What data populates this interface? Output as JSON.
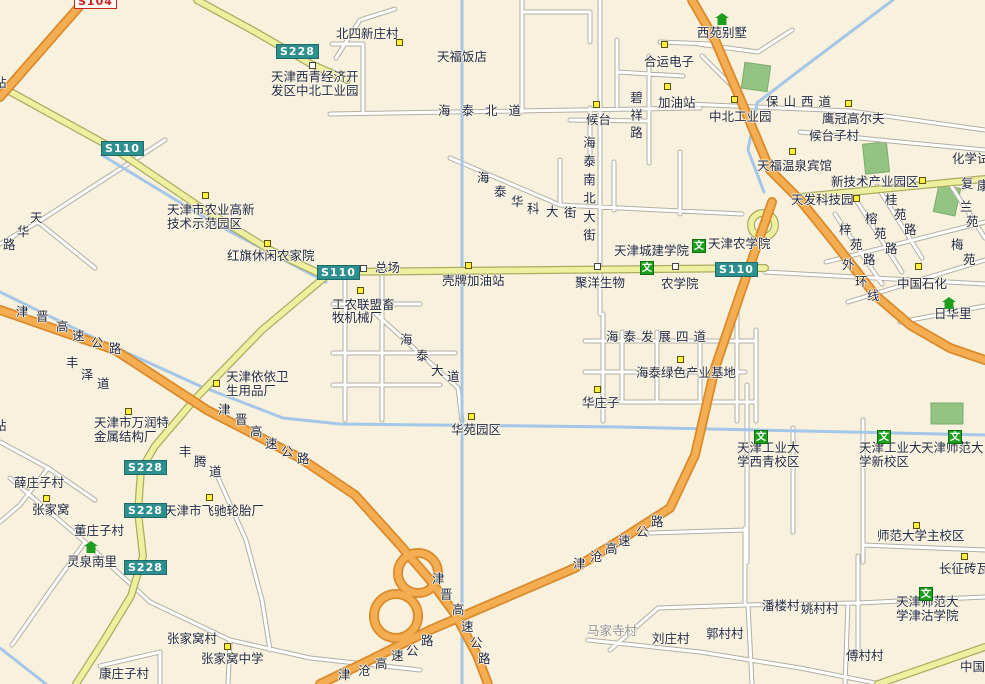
{
  "map": {
    "colors": {
      "background": "#f8f1dd",
      "road_fill": "#ffffff",
      "road_border": "#b2aea4",
      "provincial_road": "#eef0a0",
      "provincial_border": "#aaac62",
      "expressway": "#f5ad52",
      "expressway_border": "#d98a2b",
      "river": "#a4c6e8",
      "park": "#94c483",
      "badge_teal": "#2e8f8f",
      "badge_red": "#cc2222",
      "label": "#1f2a4a"
    },
    "wen_glyph": "文",
    "road_badges": [
      {
        "label": "S104",
        "x": 74,
        "y": -6,
        "cls": "red"
      },
      {
        "label": "S228",
        "x": 276,
        "y": 44,
        "cls": ""
      },
      {
        "label": "S110",
        "x": 101,
        "y": 141,
        "cls": ""
      },
      {
        "label": "S110",
        "x": 317,
        "y": 265,
        "cls": ""
      },
      {
        "label": "S110",
        "x": 715,
        "y": 262,
        "cls": ""
      },
      {
        "label": "S228",
        "x": 124,
        "y": 460,
        "cls": ""
      },
      {
        "label": "S228",
        "x": 124,
        "y": 503,
        "cls": ""
      },
      {
        "label": "S228",
        "x": 124,
        "y": 560,
        "cls": ""
      }
    ],
    "poi_markers": [
      {
        "type": "y",
        "x": 396,
        "y": 39
      },
      {
        "type": "y",
        "x": 661,
        "y": 41
      },
      {
        "type": "y",
        "x": 664,
        "y": 83
      },
      {
        "type": "y",
        "x": 593,
        "y": 101
      },
      {
        "type": "y",
        "x": 731,
        "y": 96
      },
      {
        "type": "y",
        "x": 845,
        "y": 100
      },
      {
        "type": "y",
        "x": 789,
        "y": 148
      },
      {
        "type": "y",
        "x": 919,
        "y": 177
      },
      {
        "type": "y",
        "x": 853,
        "y": 195
      },
      {
        "type": "y",
        "x": 915,
        "y": 263
      },
      {
        "type": "y",
        "x": 202,
        "y": 192
      },
      {
        "type": "y",
        "x": 264,
        "y": 240
      },
      {
        "type": "y",
        "x": 465,
        "y": 262
      },
      {
        "type": "y",
        "x": 357,
        "y": 287
      },
      {
        "type": "y",
        "x": 677,
        "y": 356
      },
      {
        "type": "y",
        "x": 594,
        "y": 386
      },
      {
        "type": "y",
        "x": 468,
        "y": 413
      },
      {
        "type": "y",
        "x": 213,
        "y": 380
      },
      {
        "type": "y",
        "x": 125,
        "y": 408
      },
      {
        "type": "y",
        "x": 43,
        "y": 495
      },
      {
        "type": "y",
        "x": 206,
        "y": 494
      },
      {
        "type": "y",
        "x": 224,
        "y": 643
      },
      {
        "type": "y",
        "x": 913,
        "y": 522
      },
      {
        "type": "y",
        "x": 961,
        "y": 553
      },
      {
        "type": "w",
        "x": 309,
        "y": 62
      },
      {
        "type": "w",
        "x": 360,
        "y": 265
      },
      {
        "type": "w",
        "x": 594,
        "y": 263
      },
      {
        "type": "w",
        "x": 672,
        "y": 263
      },
      {
        "type": "wen",
        "x": 692,
        "y": 239
      },
      {
        "type": "wen",
        "x": 640,
        "y": 261
      },
      {
        "type": "wen",
        "x": 754,
        "y": 430
      },
      {
        "type": "wen",
        "x": 877,
        "y": 430
      },
      {
        "type": "wen",
        "x": 948,
        "y": 430
      },
      {
        "type": "wen",
        "x": 919,
        "y": 587
      },
      {
        "type": "house",
        "x": 715,
        "y": 13
      },
      {
        "type": "house",
        "x": 942,
        "y": 297
      },
      {
        "type": "house",
        "x": 84,
        "y": 541
      }
    ],
    "region_labels": [
      {
        "t": "北四新庄村",
        "x": 336,
        "y": 27
      },
      {
        "t": "天福饭店",
        "x": 437,
        "y": 50
      },
      {
        "t": "天津西青经济开",
        "x": 271,
        "y": 70
      },
      {
        "t": "发区中北工业园",
        "x": 271,
        "y": 84
      },
      {
        "t": "西苑别墅",
        "x": 697,
        "y": 26
      },
      {
        "t": "合运电子",
        "x": 644,
        "y": 55
      },
      {
        "t": "保山西道",
        "x": 766,
        "y": 95,
        "cls": "sp2"
      },
      {
        "t": "加油站",
        "x": 658,
        "y": 96
      },
      {
        "t": "中北工业园",
        "x": 709,
        "y": 110
      },
      {
        "t": "鹰冠高尔夫",
        "x": 822,
        "y": 112
      },
      {
        "t": "候台",
        "x": 586,
        "y": 113
      },
      {
        "t": "候台子村",
        "x": 809,
        "y": 129
      },
      {
        "t": "海泰北道",
        "x": 438,
        "y": 104,
        "cls": "sp1"
      },
      {
        "t": "碧祥路",
        "x": 629,
        "y": 91,
        "cls": "vert"
      },
      {
        "t": "海泰南北大街",
        "x": 582,
        "y": 136,
        "cls": "vert2"
      },
      {
        "t": "化学试",
        "x": 952,
        "y": 152
      },
      {
        "t": "天福温泉宾馆",
        "x": 757,
        "y": 159
      },
      {
        "t": "新技术产业园区",
        "x": 831,
        "y": 175
      },
      {
        "t": "天发科技园",
        "x": 791,
        "y": 193
      },
      {
        "t": "复",
        "x": 961,
        "y": 177
      },
      {
        "t": "康",
        "x": 977,
        "y": 179
      },
      {
        "t": "桂",
        "x": 885,
        "y": 193
      },
      {
        "t": "苑",
        "x": 894,
        "y": 208
      },
      {
        "t": "路",
        "x": 904,
        "y": 223
      },
      {
        "t": "榕",
        "x": 865,
        "y": 212
      },
      {
        "t": "苑",
        "x": 874,
        "y": 227
      },
      {
        "t": "路",
        "x": 885,
        "y": 242
      },
      {
        "t": "梓",
        "x": 839,
        "y": 223
      },
      {
        "t": "苑",
        "x": 850,
        "y": 238
      },
      {
        "t": "路",
        "x": 863,
        "y": 253
      },
      {
        "t": "兰",
        "x": 960,
        "y": 200
      },
      {
        "t": "苑",
        "x": 966,
        "y": 215
      },
      {
        "t": "梅",
        "x": 951,
        "y": 238
      },
      {
        "t": "苑",
        "x": 963,
        "y": 253
      },
      {
        "t": "外",
        "x": 842,
        "y": 258
      },
      {
        "t": "环",
        "x": 855,
        "y": 275
      },
      {
        "t": "线",
        "x": 867,
        "y": 289
      },
      {
        "t": "中国石化",
        "x": 897,
        "y": 277
      },
      {
        "t": "天津农学院",
        "x": 708,
        "y": 237
      },
      {
        "t": "天津城建学院",
        "x": 614,
        "y": 244
      },
      {
        "t": "农学院",
        "x": 661,
        "y": 277
      },
      {
        "t": "聚洋生物",
        "x": 575,
        "y": 276
      },
      {
        "t": "总场",
        "x": 375,
        "y": 261
      },
      {
        "t": "壳牌加油站",
        "x": 442,
        "y": 274
      },
      {
        "t": "日华里",
        "x": 934,
        "y": 307
      },
      {
        "t": "天津市农业高新",
        "x": 167,
        "y": 203
      },
      {
        "t": "技术示范园区",
        "x": 167,
        "y": 217
      },
      {
        "t": "红旗休闲农家院",
        "x": 227,
        "y": 249
      },
      {
        "t": "天",
        "x": 30,
        "y": 211
      },
      {
        "t": "华",
        "x": 17,
        "y": 225
      },
      {
        "t": "路",
        "x": 3,
        "y": 238
      },
      {
        "t": "海",
        "x": 477,
        "y": 171
      },
      {
        "t": "泰",
        "x": 494,
        "y": 185
      },
      {
        "t": "华",
        "x": 511,
        "y": 195
      },
      {
        "t": "科",
        "x": 527,
        "y": 202
      },
      {
        "t": "大",
        "x": 546,
        "y": 205
      },
      {
        "t": "街",
        "x": 564,
        "y": 206
      },
      {
        "t": "工农联盟畜",
        "x": 332,
        "y": 298
      },
      {
        "t": "牧机械厂",
        "x": 332,
        "y": 311
      },
      {
        "t": "海",
        "x": 400,
        "y": 333
      },
      {
        "t": "泰",
        "x": 416,
        "y": 349
      },
      {
        "t": "大",
        "x": 431,
        "y": 364
      },
      {
        "t": "道",
        "x": 447,
        "y": 370
      },
      {
        "t": "海泰发展四道",
        "x": 606,
        "y": 330,
        "cls": "sp2"
      },
      {
        "t": "海泰绿色产业基地",
        "x": 636,
        "y": 366
      },
      {
        "t": "华庄子",
        "x": 582,
        "y": 396
      },
      {
        "t": "华苑园区",
        "x": 451,
        "y": 423
      },
      {
        "t": "津",
        "x": 16,
        "y": 305
      },
      {
        "t": "晋",
        "x": 36,
        "y": 310
      },
      {
        "t": "高",
        "x": 56,
        "y": 320
      },
      {
        "t": "速",
        "x": 72,
        "y": 329
      },
      {
        "t": "公",
        "x": 91,
        "y": 336
      },
      {
        "t": "路",
        "x": 109,
        "y": 342
      },
      {
        "t": "丰",
        "x": 66,
        "y": 356
      },
      {
        "t": "泽",
        "x": 81,
        "y": 368
      },
      {
        "t": "道",
        "x": 97,
        "y": 377
      },
      {
        "t": "天津依依卫",
        "x": 226,
        "y": 370
      },
      {
        "t": "生用品厂",
        "x": 226,
        "y": 384
      },
      {
        "t": "津",
        "x": 218,
        "y": 403
      },
      {
        "t": "晋",
        "x": 235,
        "y": 413
      },
      {
        "t": "高",
        "x": 250,
        "y": 425
      },
      {
        "t": "速",
        "x": 265,
        "y": 437
      },
      {
        "t": "公",
        "x": 281,
        "y": 445
      },
      {
        "t": "路",
        "x": 297,
        "y": 452
      },
      {
        "t": "天津市万润特",
        "x": 94,
        "y": 416
      },
      {
        "t": "金属结构厂",
        "x": 94,
        "y": 430
      },
      {
        "t": "丰",
        "x": 179,
        "y": 445
      },
      {
        "t": "腾",
        "x": 194,
        "y": 455
      },
      {
        "t": "道",
        "x": 209,
        "y": 465
      },
      {
        "t": "薛庄子村",
        "x": 14,
        "y": 476
      },
      {
        "t": "站",
        "x": -6,
        "y": 76
      },
      {
        "t": "站",
        "x": -6,
        "y": 419
      },
      {
        "t": "张家窝",
        "x": 32,
        "y": 503
      },
      {
        "t": "天津市飞驰轮胎厂",
        "x": 164,
        "y": 504
      },
      {
        "t": "董庄子村",
        "x": 74,
        "y": 524
      },
      {
        "t": "灵泉南里",
        "x": 67,
        "y": 555
      },
      {
        "t": "张家窝村",
        "x": 167,
        "y": 632
      },
      {
        "t": "张家窝中学",
        "x": 201,
        "y": 652
      },
      {
        "t": "康庄子村",
        "x": 99,
        "y": 667
      },
      {
        "t": "天津工业大",
        "x": 737,
        "y": 441
      },
      {
        "t": "学西青校区",
        "x": 737,
        "y": 455
      },
      {
        "t": "天津工业大",
        "x": 859,
        "y": 441
      },
      {
        "t": "学新校区",
        "x": 859,
        "y": 455
      },
      {
        "t": "天津师范大",
        "x": 921,
        "y": 441
      },
      {
        "t": "师范大学主校区",
        "x": 877,
        "y": 529
      },
      {
        "t": "长征砖瓦",
        "x": 939,
        "y": 562
      },
      {
        "t": "天津师范大",
        "x": 896,
        "y": 595
      },
      {
        "t": "学津沽学院",
        "x": 896,
        "y": 609
      },
      {
        "t": "潘楼村",
        "x": 762,
        "y": 599
      },
      {
        "t": "姚村村",
        "x": 801,
        "y": 602
      },
      {
        "t": "郭村村",
        "x": 706,
        "y": 627
      },
      {
        "t": "刘庄村",
        "x": 652,
        "y": 632
      },
      {
        "t": "傅村村",
        "x": 846,
        "y": 649
      },
      {
        "t": "马家寺村",
        "x": 587,
        "y": 624,
        "cls": "dim"
      },
      {
        "t": "中国",
        "x": 960,
        "y": 660
      },
      {
        "t": "津",
        "x": 573,
        "y": 557
      },
      {
        "t": "沧",
        "x": 590,
        "y": 550
      },
      {
        "t": "高",
        "x": 605,
        "y": 542
      },
      {
        "t": "速",
        "x": 618,
        "y": 534
      },
      {
        "t": "公",
        "x": 636,
        "y": 525
      },
      {
        "t": "路",
        "x": 651,
        "y": 515
      },
      {
        "t": "津",
        "x": 432,
        "y": 572
      },
      {
        "t": "晋",
        "x": 440,
        "y": 588
      },
      {
        "t": "高",
        "x": 452,
        "y": 603
      },
      {
        "t": "速",
        "x": 461,
        "y": 620
      },
      {
        "t": "公",
        "x": 470,
        "y": 636
      },
      {
        "t": "路",
        "x": 478,
        "y": 652
      },
      {
        "t": "津",
        "x": 338,
        "y": 668
      },
      {
        "t": "沧",
        "x": 358,
        "y": 664
      },
      {
        "t": "高",
        "x": 375,
        "y": 657
      },
      {
        "t": "速",
        "x": 391,
        "y": 649
      },
      {
        "t": "公",
        "x": 406,
        "y": 644
      },
      {
        "t": "路",
        "x": 421,
        "y": 634
      }
    ]
  }
}
